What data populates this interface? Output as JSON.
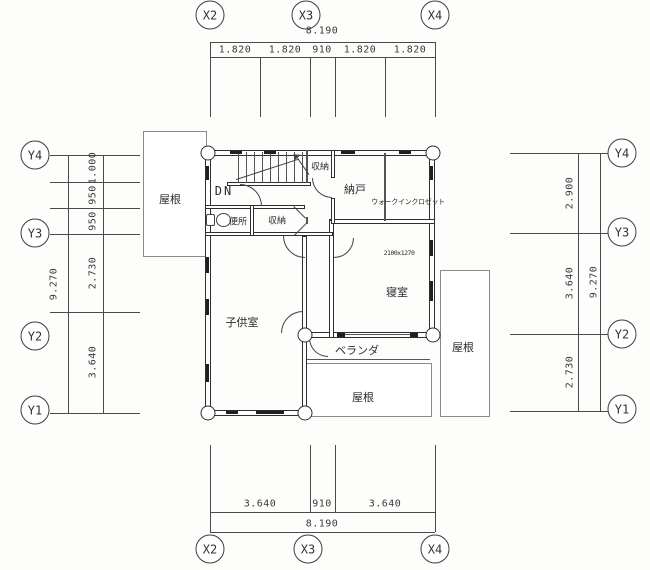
{
  "axes": {
    "top": [
      "X2",
      "X3",
      "X4"
    ],
    "bottom": [
      "X2",
      "X3",
      "X4"
    ],
    "left": [
      "Y4",
      "Y3",
      "Y2",
      "Y1"
    ],
    "right": [
      "Y4",
      "Y3",
      "Y2",
      "Y1"
    ]
  },
  "dims": {
    "top": {
      "overall": "8.190",
      "segments": [
        "1.820",
        "1.820",
        "910",
        "1.820",
        "1.820"
      ]
    },
    "bottom": {
      "overall": "8.190",
      "segments": [
        "3.640",
        "910",
        "3.640"
      ]
    },
    "left": {
      "overall": "9.270",
      "segments": [
        "1.000",
        "950",
        "950",
        "2.730",
        "3.640"
      ]
    },
    "right": {
      "overall": "9.270",
      "segments": [
        "2.900",
        "3.640",
        "2.730"
      ]
    }
  },
  "rooms": {
    "stair_down": "DN",
    "toilet": "便所",
    "closet_hall": "収納",
    "closet_stair": "収納",
    "nando": "納戸",
    "walk_in_closet": "ウォークインクロゼット",
    "kids_room": "子供室",
    "bedroom": "寝室",
    "bed_size": "2100x1270",
    "veranda": "ベランダ",
    "roof_left": "屋根",
    "roof_right": "屋根",
    "roof_bottom": "屋根"
  },
  "colors": {
    "line": "#2e2e2e",
    "dim_text": "#3a3a3a",
    "background": "#fdfdfc"
  }
}
